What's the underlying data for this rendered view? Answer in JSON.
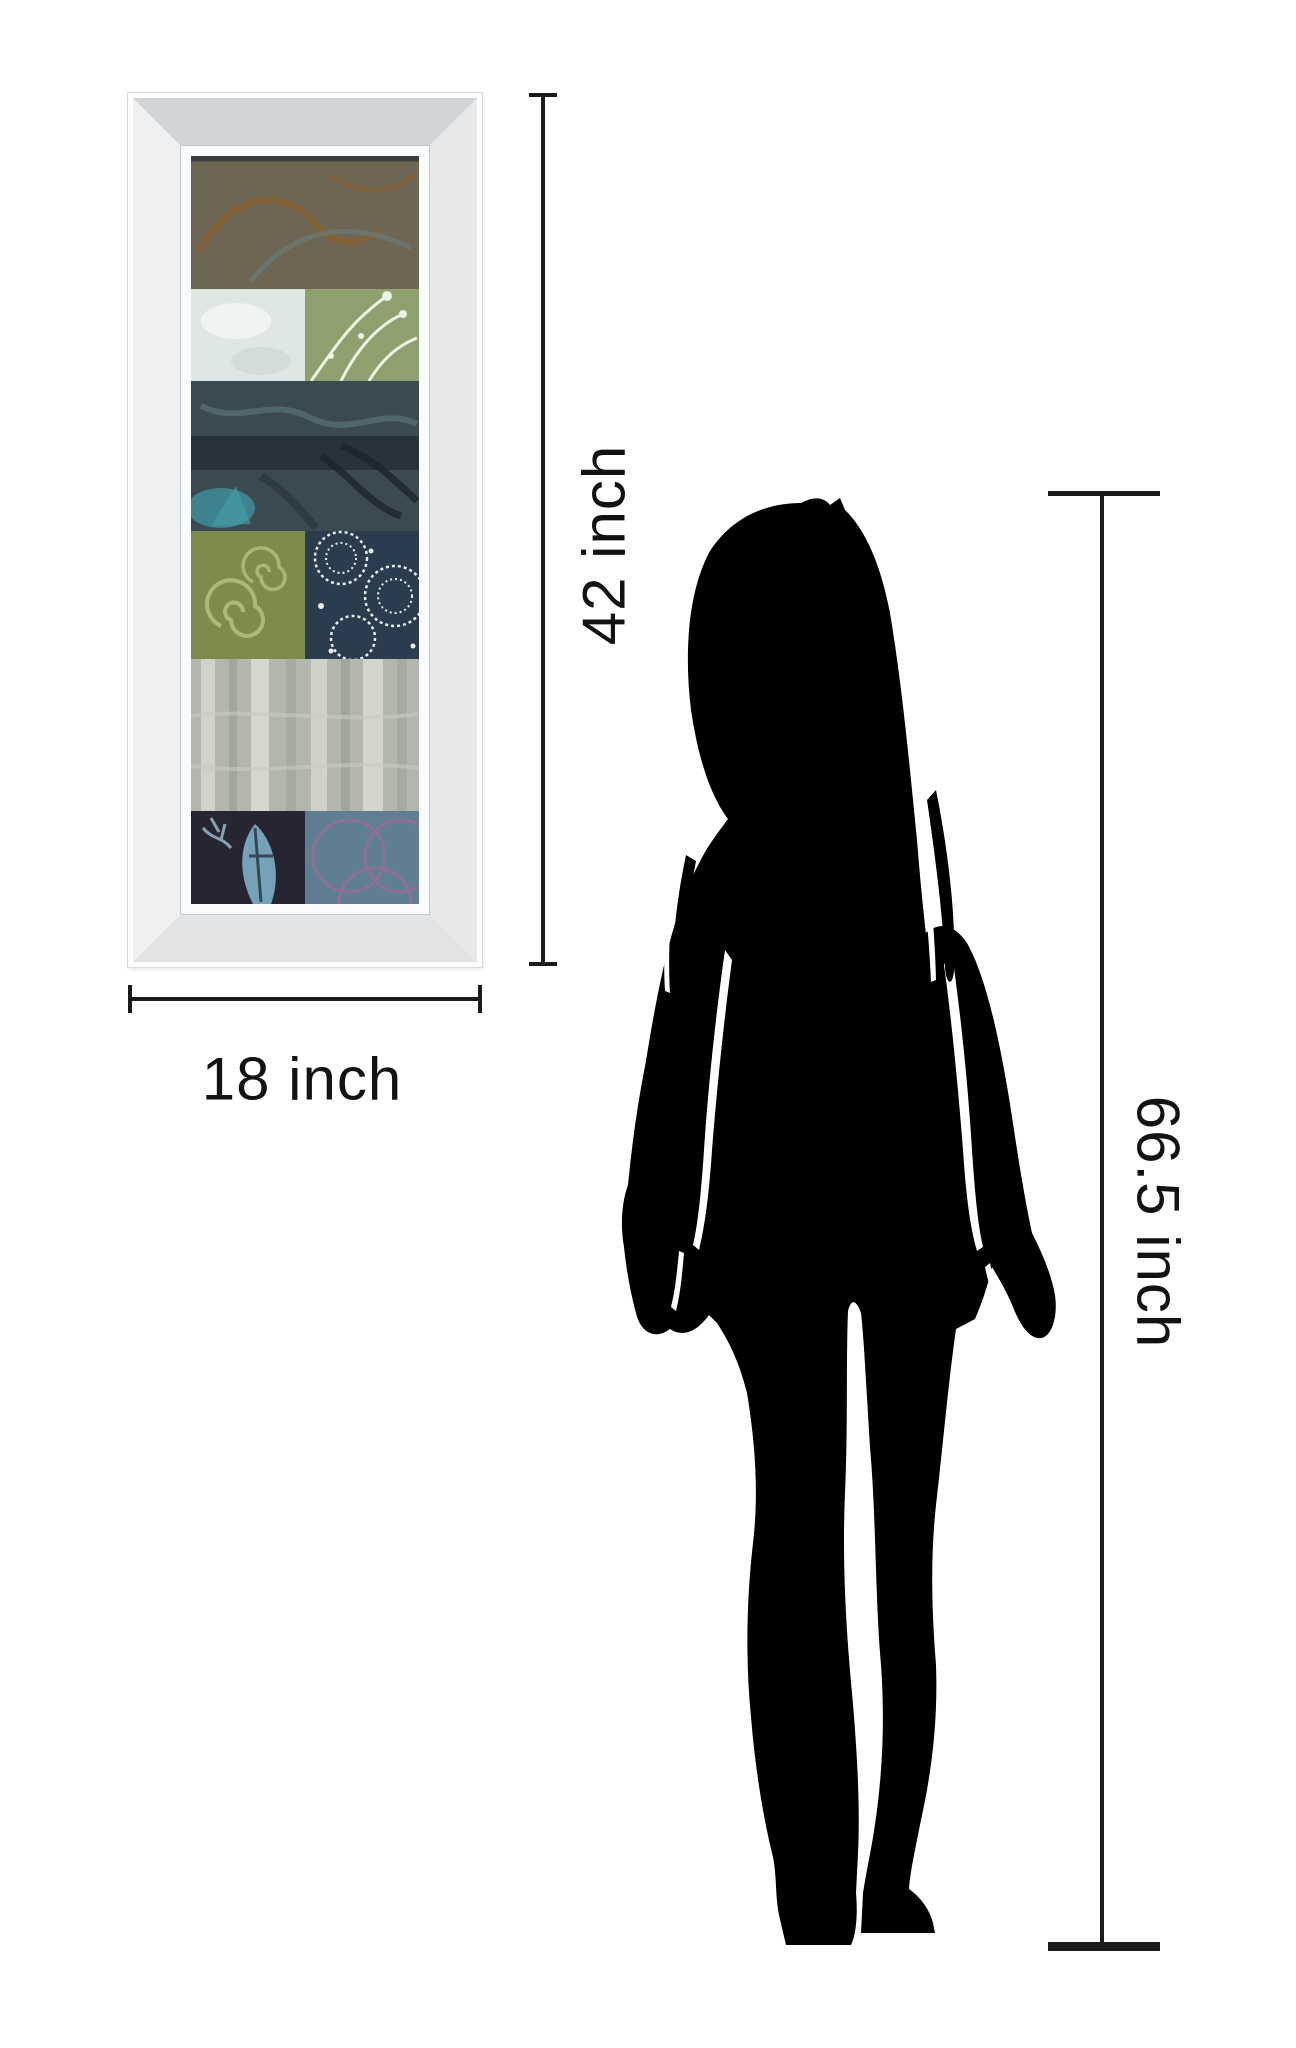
{
  "scene": {
    "type": "product-dimensions-comparison",
    "background_color": "#ffffff"
  },
  "labels": {
    "art_height": "42 inch",
    "art_width": "18 inch",
    "person_height": "66.5 inch"
  },
  "style": {
    "dimension_line_color": "#1b1b1b",
    "label_text_color": "#121212",
    "silhouette_color": "#000000",
    "frame_edge_color": "#fdfdfe",
    "frame_bevel_color": "#e1e3e5"
  },
  "artwork": {
    "description": "vertical abstract patchwork collage print in mirrored bevel frame",
    "bands": [
      {
        "name": "rust-swirls-on-slate",
        "colors": [
          "#636d6a",
          "#7f5c33"
        ]
      },
      {
        "name": "pale-blue-block-and-sage-botanicals",
        "colors": [
          "#dfe7e3",
          "#8fa06f"
        ]
      },
      {
        "name": "dark-teal-leaf-batik",
        "colors": [
          "#3a4a50",
          "#3f96a3"
        ]
      },
      {
        "name": "olive-spirals-and-navy-lace-medallions",
        "colors": [
          "#7e8c4b",
          "#2a3c4d"
        ]
      },
      {
        "name": "weathered-silver-texture",
        "colors": [
          "#b2b6ac",
          "#d8dbd2"
        ]
      },
      {
        "name": "indigo-batik-leaf-and-slate-rings",
        "colors": [
          "#262531",
          "#5e7e92"
        ]
      }
    ]
  },
  "figure": {
    "description": "standing woman silhouette",
    "color": "#000000"
  }
}
